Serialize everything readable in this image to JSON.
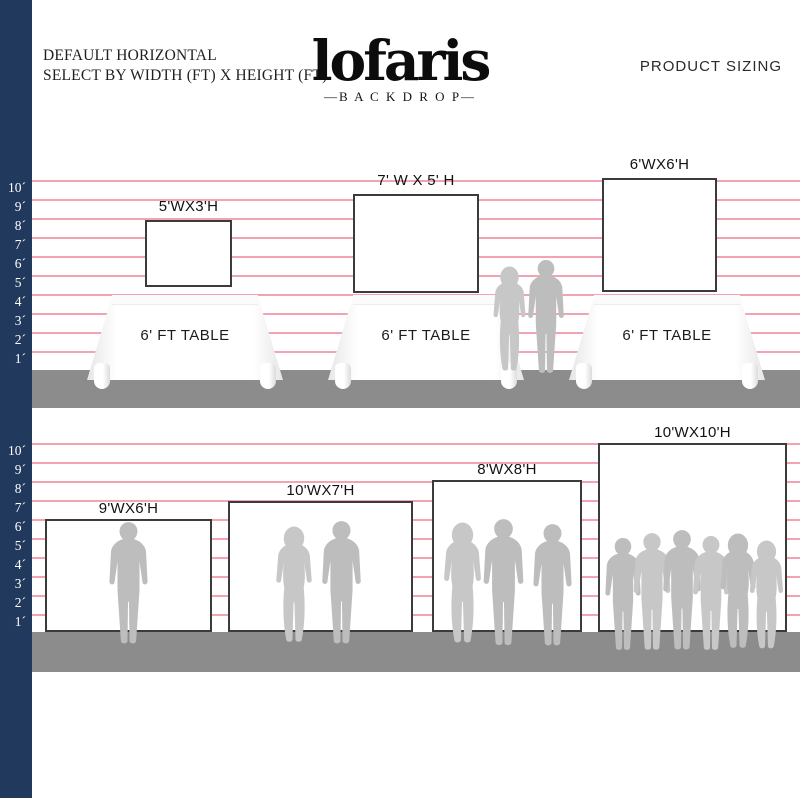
{
  "header": {
    "left_line1": "DEFAULT HORIZONTAL",
    "left_line2": "SELECT BY WIDTH (FT) X HEIGHT (FT)",
    "logo_text": "lofaris",
    "logo_sub": "—B A C K D R O P—",
    "right_title": "PRODUCT SIZING"
  },
  "ruler": {
    "labels": [
      "10´",
      "9´",
      "8´",
      "7´",
      "6´",
      "5´",
      "4´",
      "3´",
      "2´",
      "1´"
    ]
  },
  "chart_data": {
    "type": "table",
    "title": "PRODUCT SIZING",
    "unit": "feet",
    "scale_px_per_ft": 19,
    "ruler_range_ft": [
      1,
      10
    ],
    "rows": [
      {
        "setting": "on 6' FT TABLE",
        "sizes": [
          "5'WX3'H",
          "7' W X 5' H",
          "6'WX6'H"
        ]
      },
      {
        "setting": "on floor",
        "sizes": [
          "9'WX6'H",
          "10'WX7'H",
          "8'WX8'H",
          "10'WX10'H"
        ]
      }
    ]
  },
  "top_section": {
    "backdrops": [
      {
        "label": "5'WX3'H",
        "width_ft": 5,
        "height_ft": 3
      },
      {
        "label": "7' W X 5' H",
        "width_ft": 7,
        "height_ft": 5
      },
      {
        "label": "6'WX6'H",
        "width_ft": 6,
        "height_ft": 6
      }
    ],
    "table_label": "6' FT TABLE"
  },
  "bottom_section": {
    "backdrops": [
      {
        "label": "9'WX6'H",
        "width_ft": 9,
        "height_ft": 6
      },
      {
        "label": "10'WX7'H",
        "width_ft": 10,
        "height_ft": 7
      },
      {
        "label": "8'WX8'H",
        "width_ft": 8,
        "height_ft": 8
      },
      {
        "label": "10'WX10'H",
        "width_ft": 10,
        "height_ft": 10
      }
    ]
  },
  "colors": {
    "navy": "#21395c",
    "pink": "#f2a4b2",
    "floor": "#8c8c8c",
    "sil": "#bdbdbd"
  }
}
